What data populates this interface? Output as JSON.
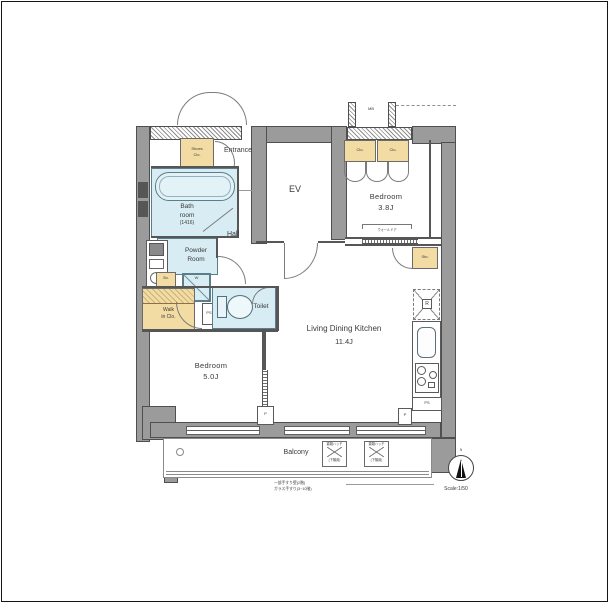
{
  "colors": {
    "wall_gray": "#9b9b9b",
    "wall_outline": "#4f4f4f",
    "closet_tan": "#f3dca4",
    "wet_area_cyan": "#d8edf3",
    "background": "#ffffff"
  },
  "rooms": {
    "entrance": {
      "label": "Entrance"
    },
    "shoes_closet": {
      "line1": "Shoes",
      "line2": "Clo."
    },
    "elevator": {
      "label": "EV"
    },
    "meter_box": {
      "label": "MB"
    },
    "bedroom_38": {
      "line1": "Bedroom",
      "line2": "3.8J",
      "closet_left": "Clo.",
      "closet_right": "Clo.",
      "storage": "Sto.",
      "fitting_note": "ウォールドア"
    },
    "hall": {
      "label": "Hall"
    },
    "bathroom": {
      "line1": "Bath",
      "line2": "room",
      "line3": "(1416)"
    },
    "powder_room": {
      "line1": "Powder",
      "line2": "Room"
    },
    "toilet": {
      "label": "Toilet"
    },
    "washer": {
      "label": "W"
    },
    "storage_small": {
      "label": "Sto."
    },
    "walk_in_closet": {
      "line1": "Walk",
      "line2": "in Clo."
    },
    "pipe_space_small": {
      "label": "PS"
    },
    "bedroom_50": {
      "line1": "Bedroom",
      "line2": "5.0J"
    },
    "ldk": {
      "line1": "Living Dining Kitchen",
      "line2": "11.4J"
    },
    "kitchen": {
      "refrigerator": "R",
      "pipe_space": "PS",
      "pillar_left": "P",
      "pillar_right": "P"
    },
    "balcony": {
      "label": "Balcony",
      "hatch1_line1": "避難ハッチ",
      "hatch1_line2": "(下階用)",
      "hatch2_line1": "避難ハッチ",
      "hatch2_line2": "(下階用)",
      "note_line1": "一部手すり壁(2階)",
      "note_line2": "ガラス手すり(3~10階)"
    },
    "compass": {
      "north": "N",
      "scale": "Scale:1/50"
    }
  }
}
